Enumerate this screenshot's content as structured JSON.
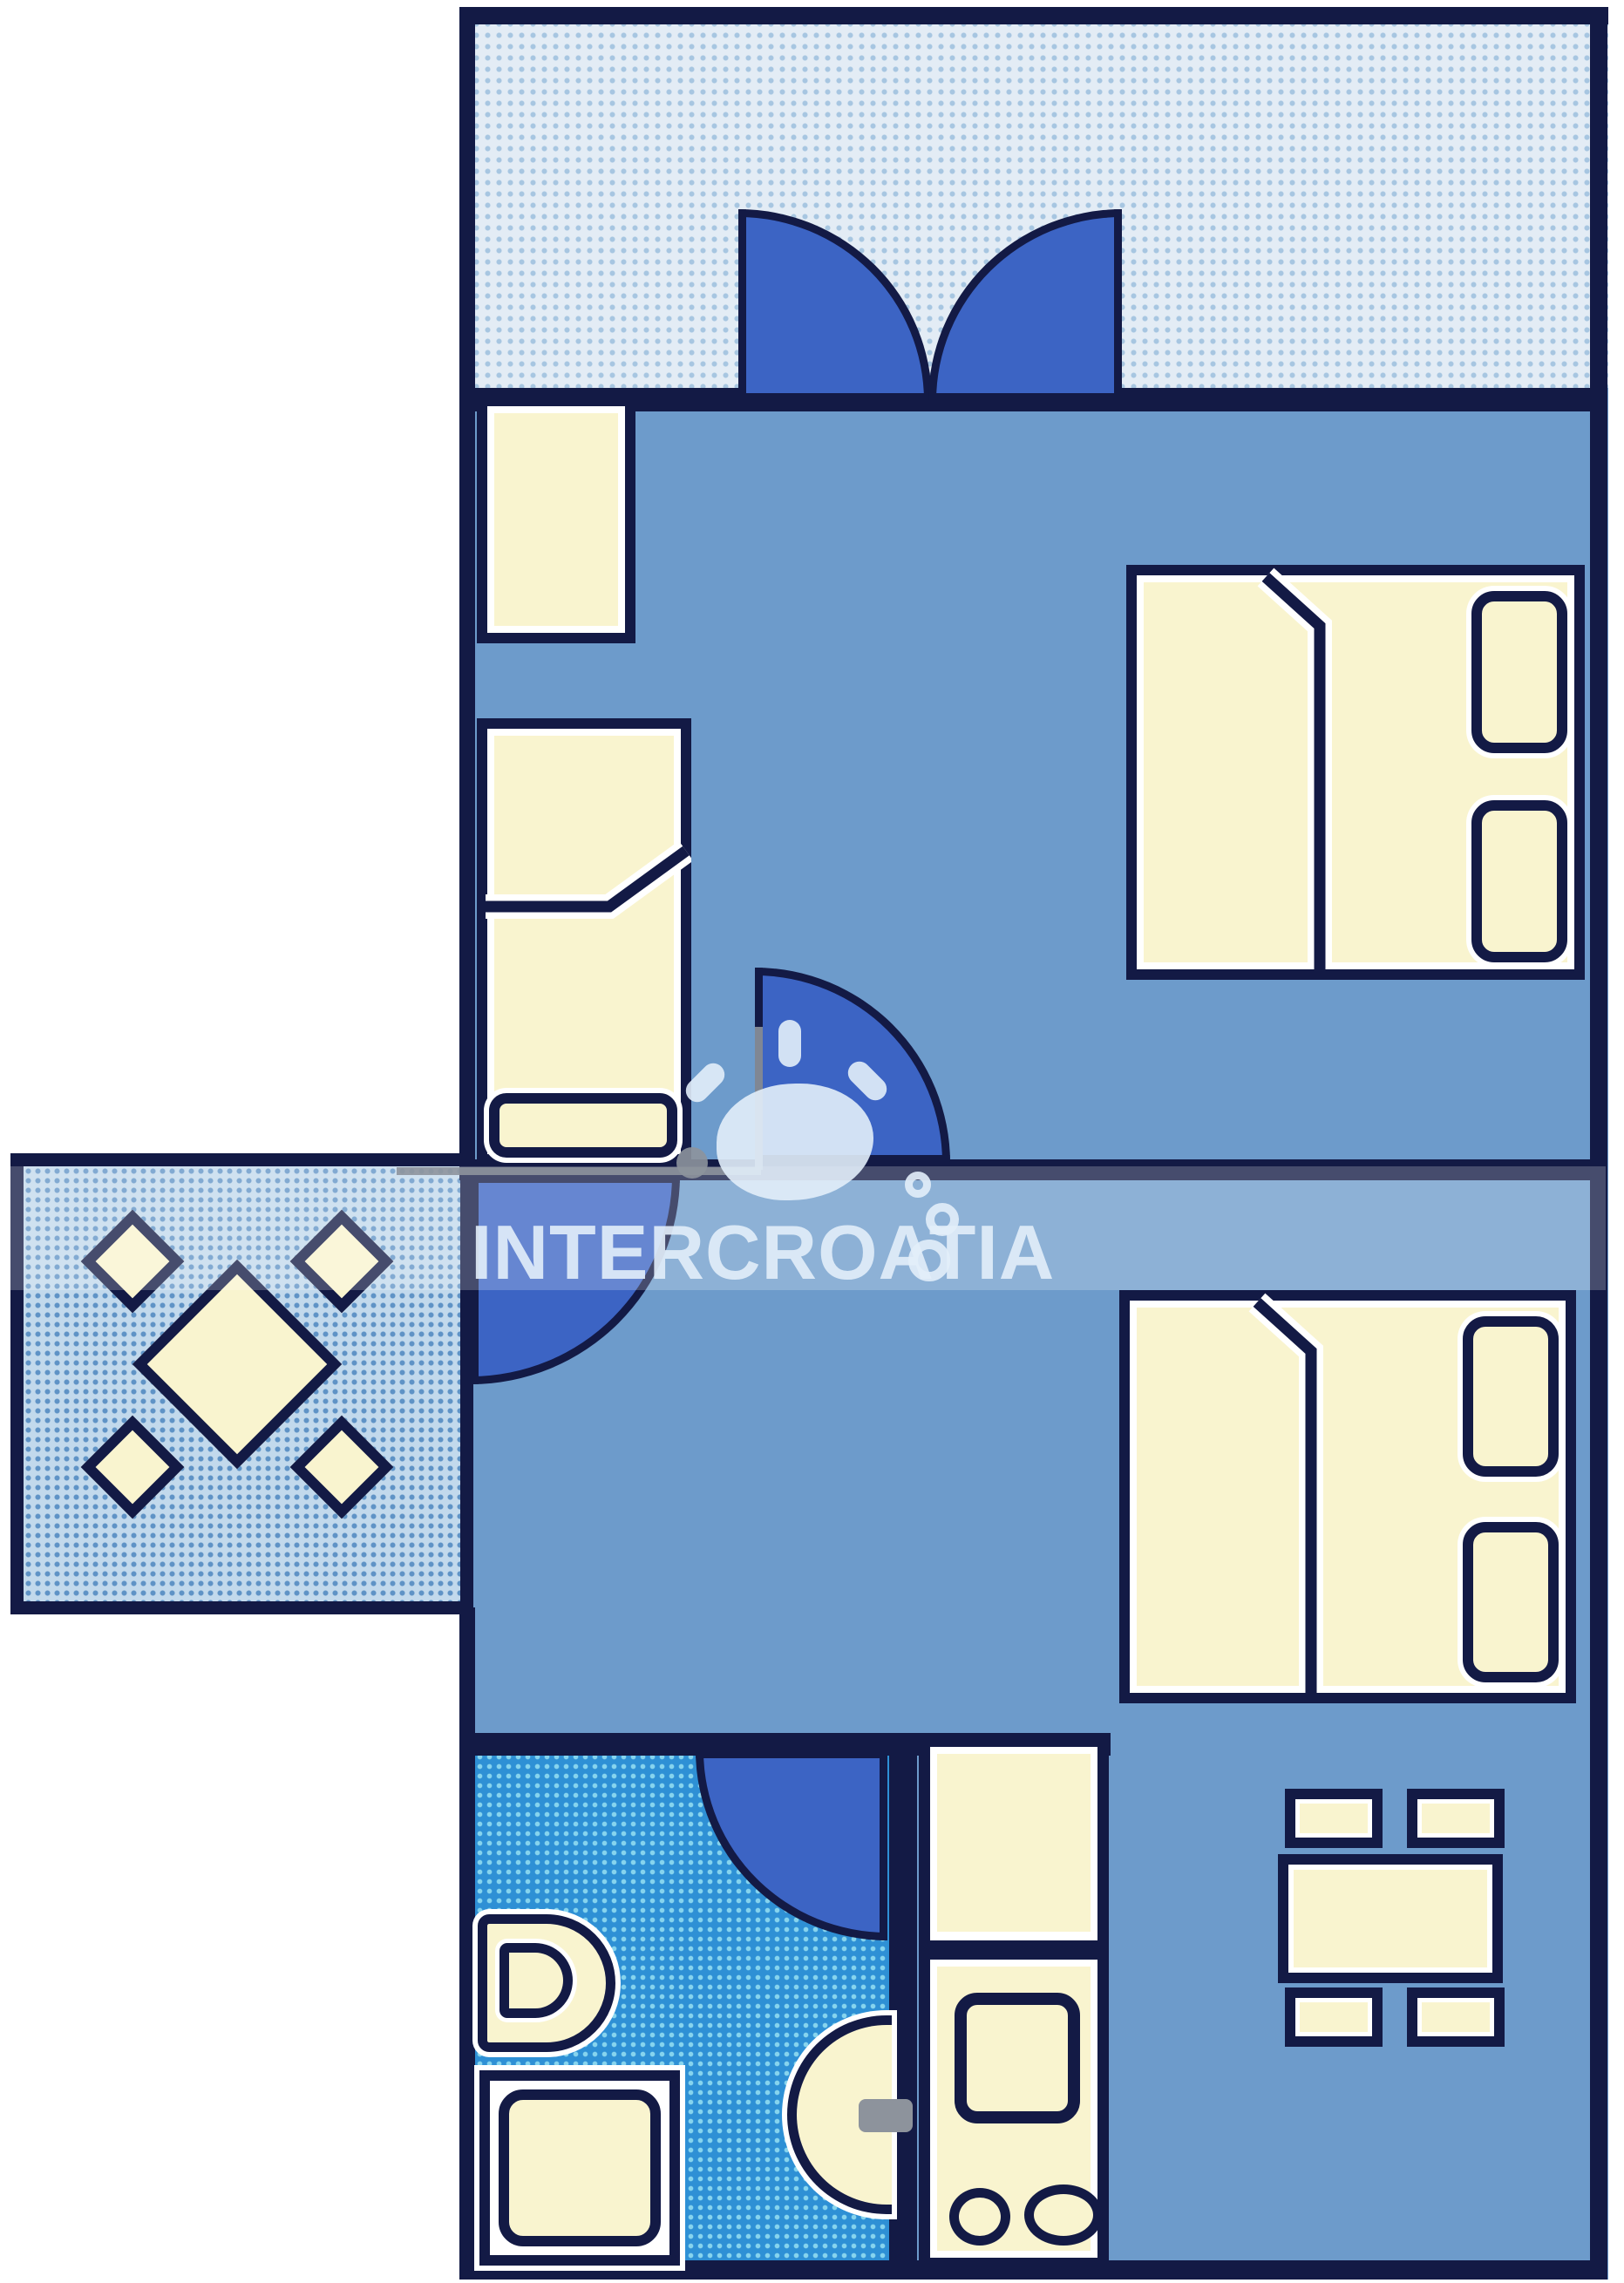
{
  "watermark": {
    "text": "INTERCROATIA",
    "logo": "sun-cloud-with-rays-and-bubbles"
  },
  "palette": {
    "wall": "#131a45",
    "room": "#6d9bcb",
    "cream": "#f9f4cf",
    "door": "#3c64c4",
    "ter_bg": "#e3ecf5",
    "ter_dot": "#a7c6e1",
    "bal_bg": "#c2d9ec",
    "bal_dot": "#5f93c6",
    "bath_bg": "#2e90d5",
    "bath_dot": "#86d4ee",
    "wm": "rgba(226,238,250,0.9)",
    "gray": "#8d939c"
  },
  "plan": {
    "type": "apartment-floor-plan",
    "areas": [
      "top-terrace",
      "bedroom-1",
      "left-balcony",
      "bedroom-2-living",
      "bathroom",
      "kitchen",
      "dining-corner"
    ],
    "furniture": [
      "wardrobe",
      "single-bed",
      "double-bed-1",
      "double-bed-2",
      "balcony-table-with-4-chairs",
      "toilet",
      "shower",
      "sink",
      "kitchen-unit-with-stove",
      "dining-table-with-4-chairs"
    ],
    "doors": [
      "terrace-double-door",
      "bedroom-1-door",
      "balcony-door",
      "bathroom-door"
    ]
  }
}
